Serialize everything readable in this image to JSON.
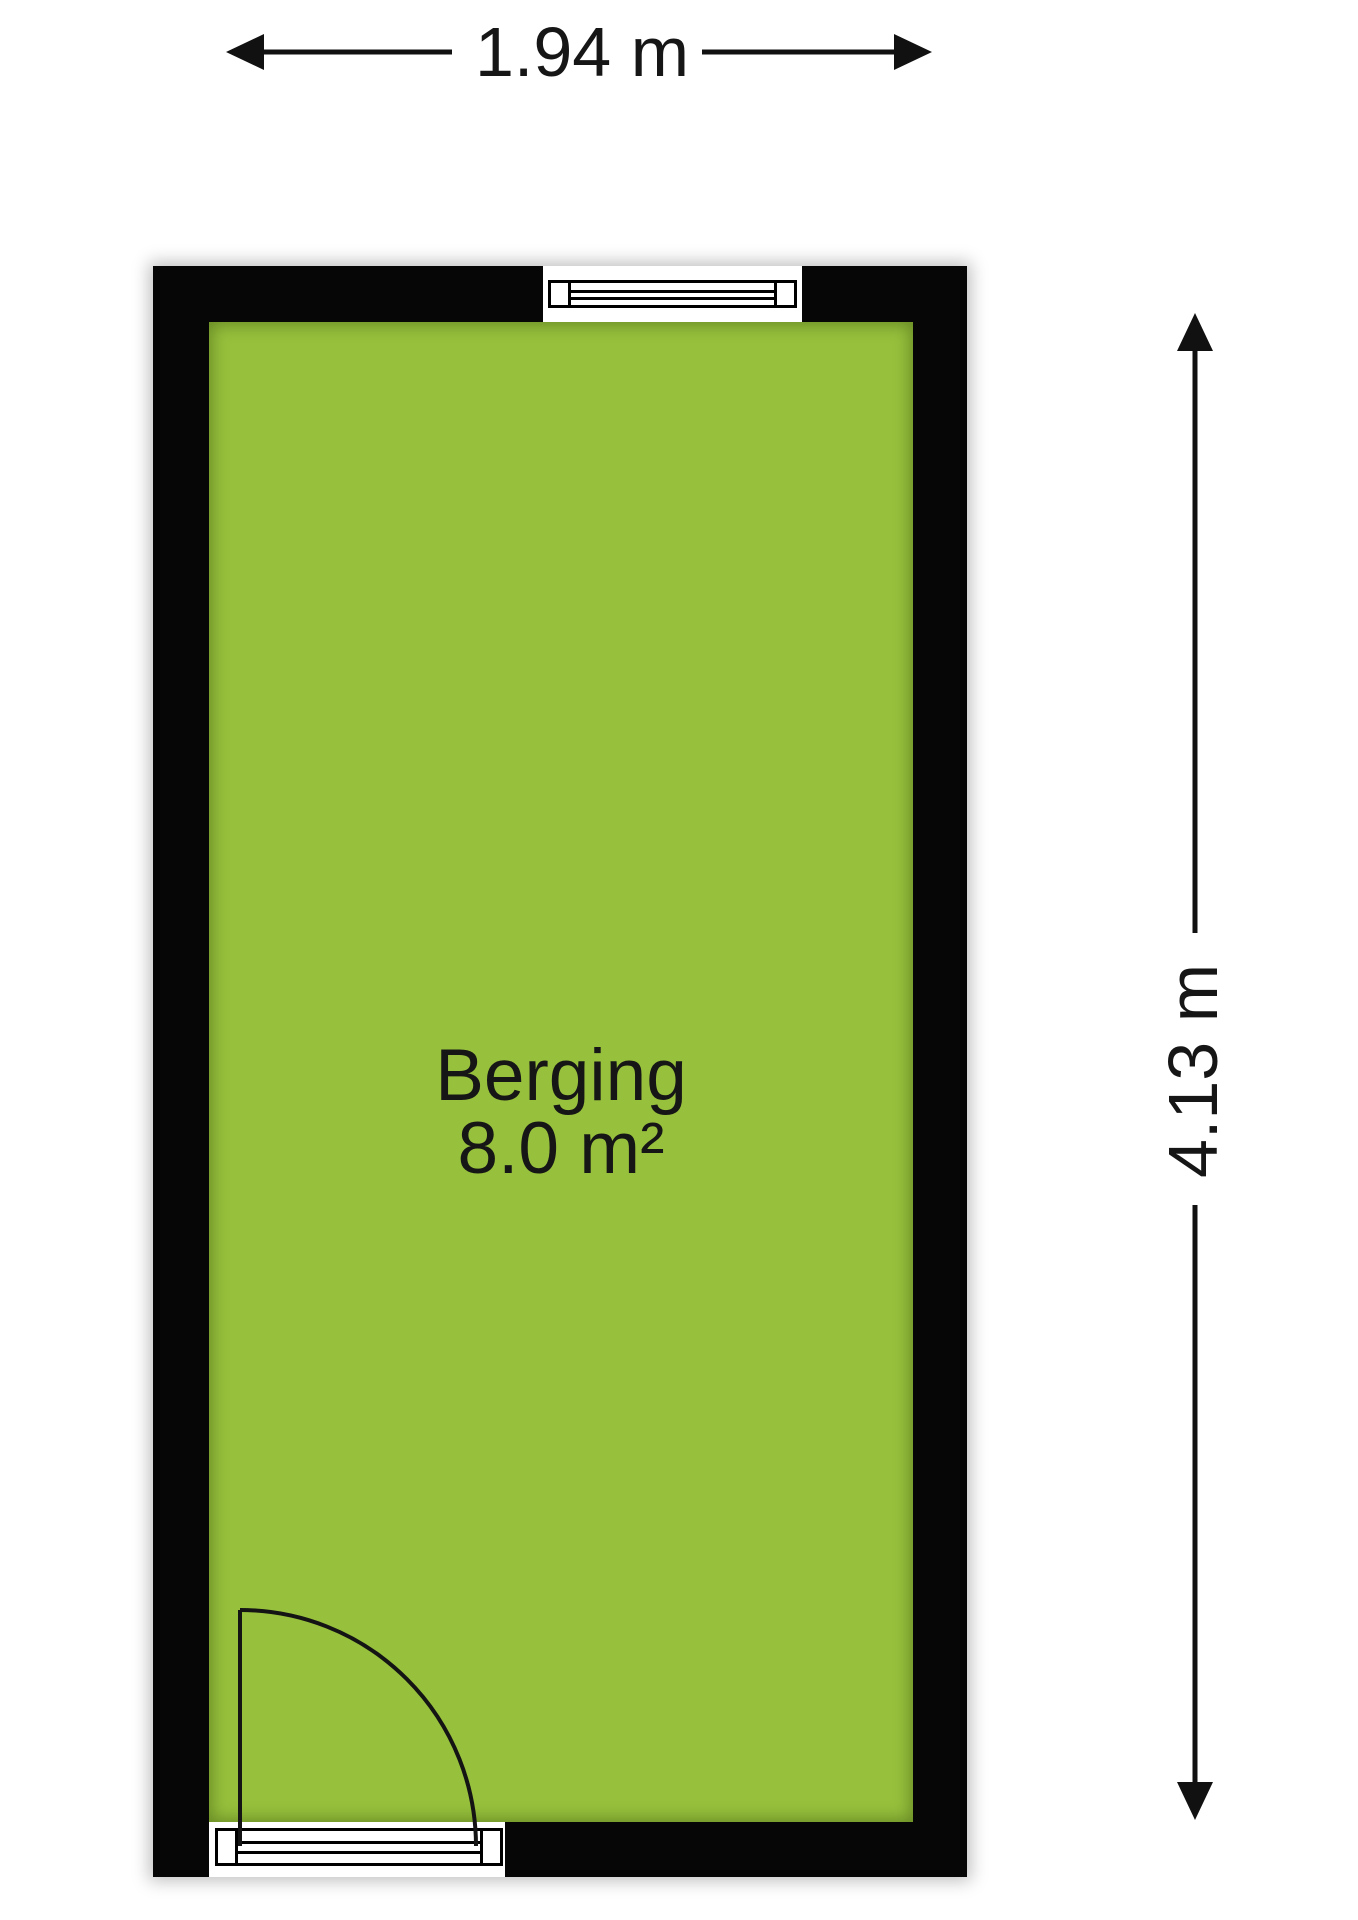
{
  "floorplan": {
    "room": {
      "name": "Berging",
      "area_label": "8.0 m²"
    },
    "dimensions": {
      "width_label": "1.94 m",
      "height_label": "4.13 m"
    },
    "colors": {
      "floor_fill": "#97c13c",
      "wall": "#060606",
      "text": "#161616"
    },
    "symbols": {
      "top_window": "window-symbol",
      "bottom_window": "window-symbol",
      "door": "door-swing-symbol"
    }
  }
}
